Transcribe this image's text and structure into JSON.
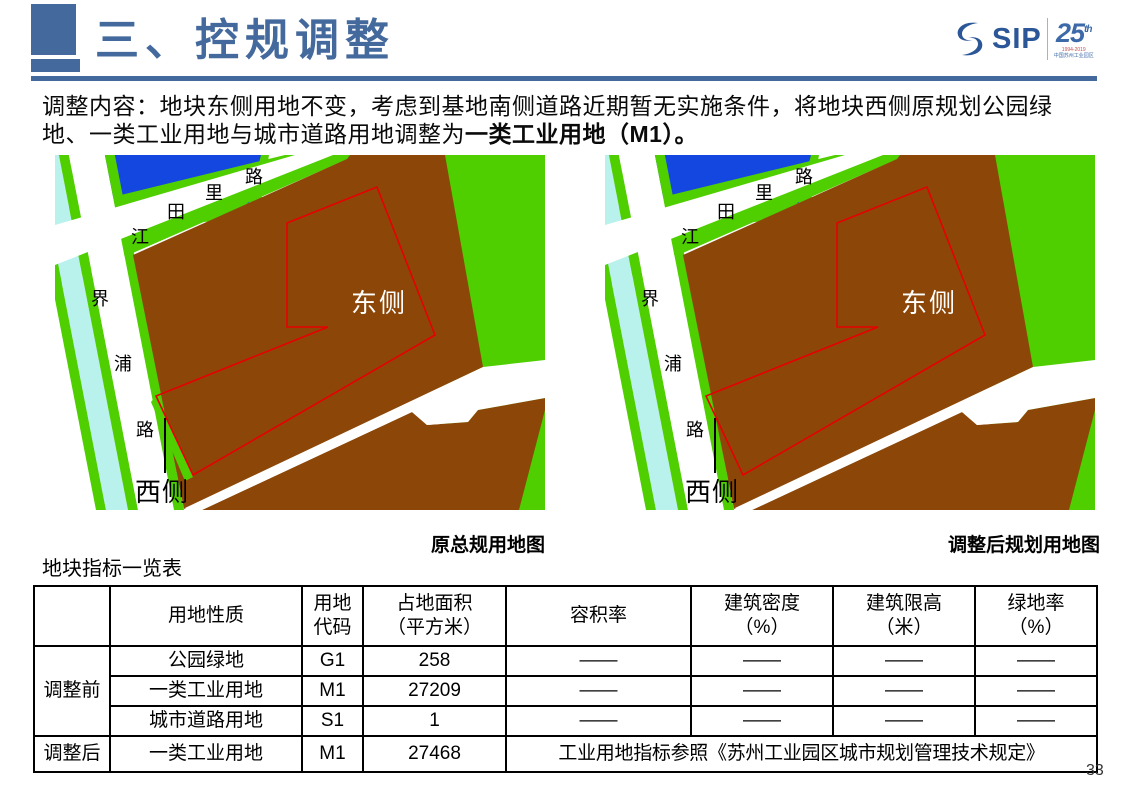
{
  "header": {
    "title": "三、控规调整",
    "logo": {
      "sip": "SIP",
      "anniversary": "25",
      "anniversary_sup": "th",
      "years": "1994-2019",
      "tagline": "中国苏州工业园区"
    }
  },
  "intro": {
    "line1": "调整内容：地块东侧用地不变，考虑到基地南侧道路近期暂无实施条件，将地块西侧原规划公园绿",
    "line2_regular": "地、一类工业用地与城市道路用地调整为",
    "line2_bold": "一类工业用地（M1）。"
  },
  "maps": {
    "east_label": "东侧",
    "west_label": "西侧",
    "road_a": [
      "江",
      "田",
      "里",
      "路"
    ],
    "road_b": [
      "界",
      "浦",
      "路"
    ],
    "left_caption": "原总规用地图",
    "right_caption": "调整后规划用地图",
    "colors": {
      "industrial_brown": "#8C4708",
      "greenery": "#4FCE00",
      "water_blue": "#1347E0",
      "canal_cyan": "#B9F1EC",
      "road_white": "#FFFFFF",
      "plot_outline_red": "#E60000"
    }
  },
  "table": {
    "title": "地块指标一览表",
    "headers": {
      "group": "",
      "nature": "用地性质",
      "code_l1": "用地",
      "code_l2": "代码",
      "area_l1": "占地面积",
      "area_l2": "（平方米）",
      "far": "容积率",
      "density_l1": "建筑密度",
      "density_l2": "（%）",
      "height_l1": "建筑限高",
      "height_l2": "（米）",
      "greenrate_l1": "绿地率",
      "greenrate_l2": "（%）"
    },
    "rows": [
      {
        "group": "调整前",
        "cells": [
          "公园绿地",
          "G1",
          "258",
          "——",
          "——",
          "——",
          "——"
        ]
      },
      {
        "cells": [
          "一类工业用地",
          "M1",
          "27209",
          "——",
          "——",
          "——",
          "——"
        ]
      },
      {
        "cells": [
          "城市道路用地",
          "S1",
          "1",
          "——",
          "——",
          "——",
          "——"
        ]
      },
      {
        "group": "调整后",
        "cells": [
          "一类工业用地",
          "M1",
          "27468"
        ],
        "note": "工业用地指标参照《苏州工业园区城市规划管理技术规定》"
      }
    ]
  },
  "page_number": "33"
}
